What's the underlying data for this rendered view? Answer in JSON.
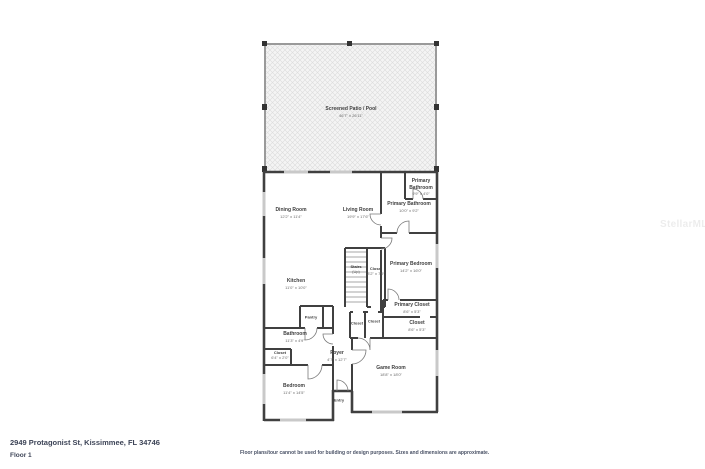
{
  "footer": {
    "address": "2949 Protagonist St, Kissimmee, FL 34746",
    "floor": "Floor 1",
    "disclaimer": "Floor plans/tour cannot be used for building or design purposes. Sizes and dimensions are approximate."
  },
  "watermark": "StellarMLS",
  "colors": {
    "wall": "#404040",
    "patio_wall": "#9a9a9a",
    "window": "#c9c9c9",
    "hatch_line": "#dcdcdc",
    "hatch_bg": "#f4f4f4",
    "label_text": "#3f3f3f",
    "footer_text": "#3d4457"
  },
  "floor_plan": {
    "rooms": [
      {
        "name": "Screened Patio / Pool",
        "dims": "46'7\" x 26'11\""
      },
      {
        "name": "Dining Room",
        "dims": "12'2\" x 11'4\""
      },
      {
        "name": "Living Room",
        "dims": "19'9\" x 17'6\""
      },
      {
        "name": "Primary Bathroom",
        "dims": "9'9\" x 4'0\""
      },
      {
        "name": "Primary Bathroom",
        "dims": "10'0\" x 9'2\""
      },
      {
        "name": "Primary Bedroom",
        "dims": "14'2\" x 16'0\""
      },
      {
        "name": "Stairs",
        "dims": "(Up)"
      },
      {
        "name": "Closet",
        "dims": "3'2\" x 7'9\""
      },
      {
        "name": "Kitchen",
        "dims": "11'0\" x 10'0\""
      },
      {
        "name": "Pantry",
        "dims": ""
      },
      {
        "name": "Primary Closet",
        "dims": "8'6\" x 5'3\""
      },
      {
        "name": "Closet",
        "dims": "8'6\" x 5'3\""
      },
      {
        "name": "Closet",
        "dims": ""
      },
      {
        "name": "Closet",
        "dims": ""
      },
      {
        "name": "Bathroom",
        "dims": "11'3\" x 4'9\""
      },
      {
        "name": "Closet",
        "dims": "6'4\" x 2'0\""
      },
      {
        "name": "Foyer",
        "dims": "4'7\" x 12'7\""
      },
      {
        "name": "Bedroom",
        "dims": "11'4\" x 14'5\""
      },
      {
        "name": "Game Room",
        "dims": "18'8\" x 18'0\""
      },
      {
        "name": "Entry",
        "dims": ""
      }
    ]
  }
}
